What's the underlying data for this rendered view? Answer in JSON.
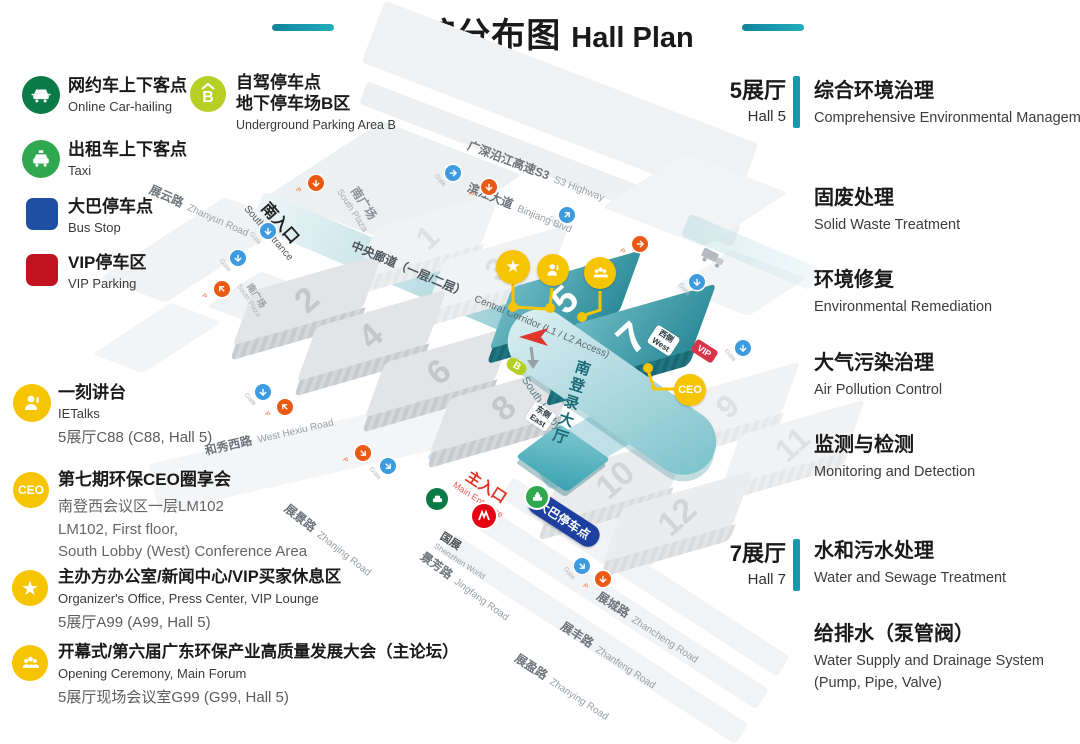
{
  "title": {
    "zh": "展馆分布图",
    "en": "Hall Plan"
  },
  "legend": {
    "transport": [
      {
        "icon": "car-hailing-icon",
        "zh": "网约车上下客点",
        "en": "Online Car-hailing"
      },
      {
        "icon": "taxi-icon",
        "zh": "出租车上下客点",
        "en": "Taxi"
      },
      {
        "icon": "bus-square-icon",
        "zh": "大巴停车点",
        "en": "Bus Stop"
      },
      {
        "icon": "vip-square-icon",
        "zh": "VIP停车区",
        "en": "VIP Parking"
      }
    ],
    "parking_b": {
      "letter": "B",
      "zh1": "自驾停车点",
      "zh2": "地下停车场B区",
      "en": "Underground Parking Area B"
    },
    "events": [
      {
        "icon": "ietalks-icon",
        "title": "一刻讲台",
        "sub": "IETalks",
        "loc": "5展厅C88 (C88, Hall 5)"
      },
      {
        "icon": "ceo-icon",
        "title": "第七期环保CEO圈享会",
        "line1": "南登西会议区一层LM102",
        "line2": "LM102, First floor,",
        "line3": "South Lobby (West) Conference Area"
      },
      {
        "icon": "star-icon",
        "title": "主办方办公室/新闻中心/VIP买家休息区",
        "sub": "Organizer's Office, Press Center, VIP Lounge",
        "loc": "5展厅A99 (A99, Hall 5)"
      },
      {
        "icon": "forum-icon",
        "title": "开幕式/第六届广东环保产业高质量发展大会（主论坛）",
        "sub": "Opening Ceremony, Main Forum",
        "loc": "5展厅现场会议室G99 (G99, Hall 5)"
      }
    ]
  },
  "right": {
    "hall5": {
      "zh": "5展厅",
      "en": "Hall 5"
    },
    "hall5_topics": [
      {
        "zh": "综合环境治理",
        "en": "Comprehensive Environmental Management"
      },
      {
        "zh": "固废处理",
        "en": "Solid Waste Treatment"
      },
      {
        "zh": "环境修复",
        "en": "Environmental Remediation"
      },
      {
        "zh": "大气污染治理",
        "en": "Air Pollution Control"
      },
      {
        "zh": "监测与检测",
        "en": "Monitoring and Detection"
      }
    ],
    "hall7": {
      "zh": "7展厅",
      "en": "Hall 7"
    },
    "hall7_topics": [
      {
        "zh": "水和污水处理",
        "en": "Water and Sewage Treatment"
      },
      {
        "zh": "给排水（泵管阀）",
        "en": "Water Supply and Drainage System (Pump, Pipe, Valve)"
      }
    ]
  },
  "map": {
    "halls": [
      "1",
      "2",
      "3",
      "4",
      "5",
      "6",
      "7",
      "8",
      "9",
      "10",
      "11",
      "12"
    ],
    "roads": [
      {
        "zh": "广深沿江高速S3",
        "en": "S3 Highway"
      },
      {
        "zh": "滨江大道",
        "en": "Binjiang Blvd"
      },
      {
        "zh": "展云路",
        "en": "Zhanyun Road"
      },
      {
        "zh": "和秀西路",
        "en": "West Hexiu Road"
      },
      {
        "zh": "展景路",
        "en": "Zhanjing Road"
      },
      {
        "zh": "景芳路",
        "en": "Jingfang Road"
      },
      {
        "zh": "展城路",
        "en": "Zhancheng Road"
      },
      {
        "zh": "展丰路",
        "en": "Zhanfeng Road"
      },
      {
        "zh": "展盈路",
        "en": "Zhanying Road"
      }
    ],
    "south_entrance": {
      "zh": "南入口",
      "en": "South Entrance"
    },
    "main_entrance": {
      "zh": "主入口",
      "en": "Main Entrance"
    },
    "south_plaza": {
      "zh": "南广场",
      "en": "South Plaza"
    },
    "central_corridor": {
      "zh": "中央廊道（一层/二层）",
      "en": "Central Corridor (L1 / L2 Access)"
    },
    "shenzhen_world": {
      "zh": "国展",
      "en": "Shenzhen World"
    },
    "bus_stop_badge": "大巴停车点",
    "lobby": {
      "zh": "南登录大厅",
      "en": "South Lobby"
    },
    "west_side": {
      "zh": "西侧",
      "en": "West"
    },
    "east_side": {
      "zh": "东侧",
      "en": "East"
    },
    "vip_badge": "VIP",
    "b_marker": "B",
    "ceo_marker": "CEO",
    "gate_label": "Gate",
    "p_label": "P",
    "colors": {
      "teal": "#1599ac",
      "hall_teal": "#2b8a98",
      "yellow": "#f7c400",
      "gate_blue": "#3f9be0",
      "p_orange": "#ea5a15",
      "bus_blue": "#1d3fa0",
      "vip_red": "#c1121f",
      "green_dark": "#0a7a46",
      "green": "#2fa84f",
      "parking_b_green": "#b5cf25",
      "entrance_red": "#e23325"
    }
  }
}
